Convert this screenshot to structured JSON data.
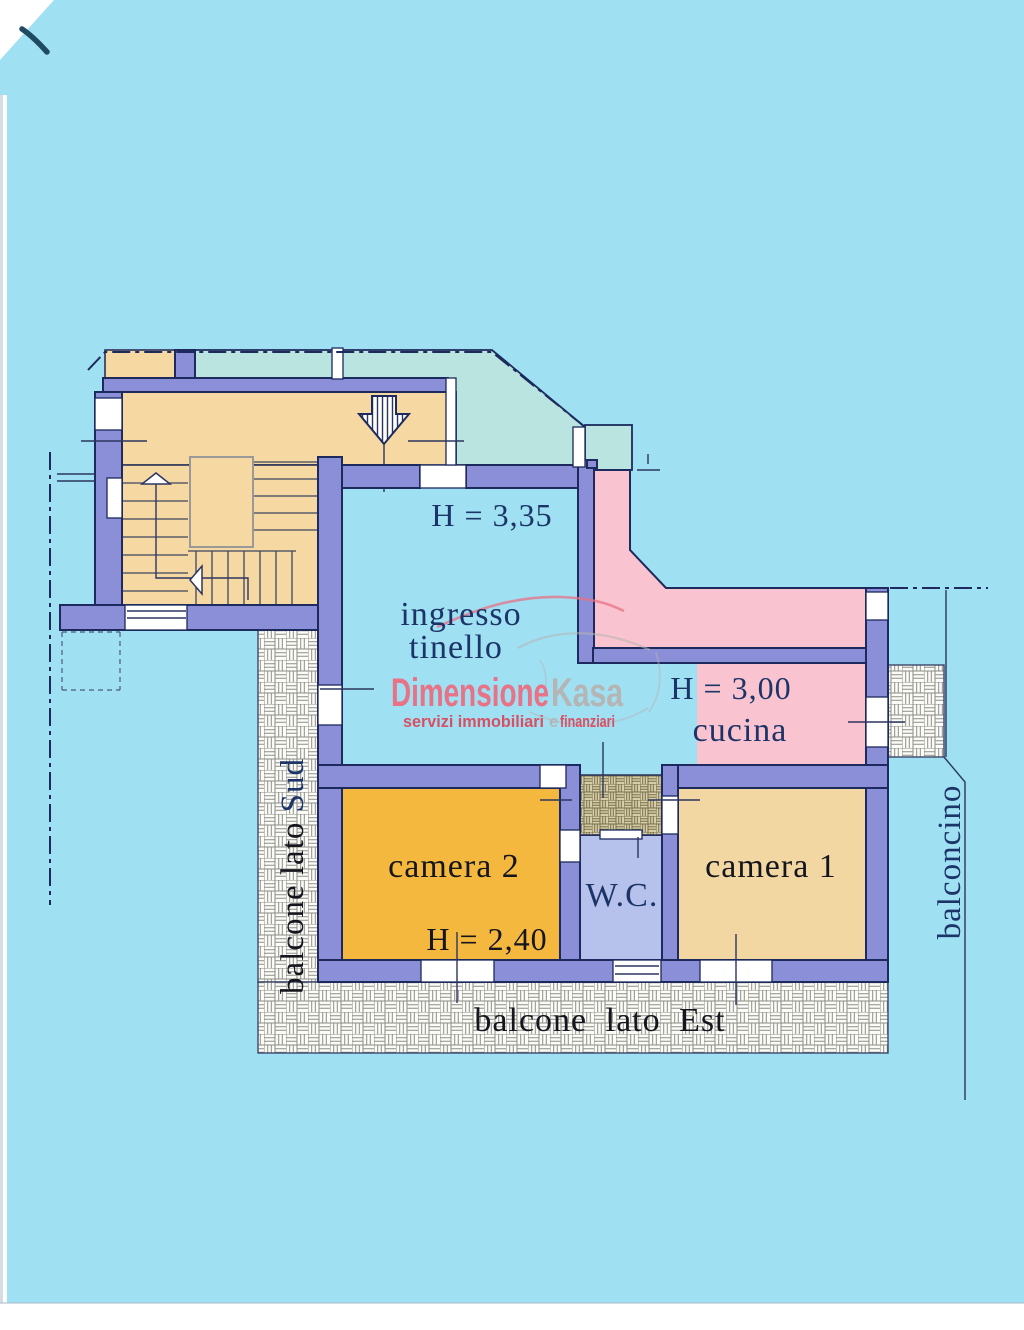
{
  "document": {
    "kind": "scanned apartment floor plan",
    "orientation_sides": [
      "Sud",
      "Est"
    ]
  },
  "labels": {
    "hall_height": "H = 3,35",
    "hall_name_line1": "ingresso",
    "hall_name_line2": "tinello",
    "kitchen_height": "H = 3,00",
    "kitchen_name": "cucina",
    "bedroom2_name": "camera 2",
    "bedroom2_height": "H = 2,40",
    "wc_name": "W.C.",
    "bedroom1_name": "camera 1",
    "balcony_south_prefix": "balcone lato ",
    "balcony_south_word": "Sud",
    "balcony_east": "balcone lato Est",
    "small_balcony": "balconcino"
  },
  "logo": {
    "brand_part1": "Dimensione",
    "brand_part2": "Kasa",
    "tagline_part1": "servizi immobiliari",
    "tagline_conj": "e",
    "tagline_part2": "finanziari"
  },
  "colors": {
    "background": "#9fe0f2",
    "wall_fill": "#8b8fd8",
    "wall_outline": "#1c2a5e",
    "neighbor_area": "#b9e4df",
    "stair_floor": "#f5d8a2",
    "camera1_floor": "#f2d7a2",
    "camera2_floor": "#f5b83e",
    "kitchen_floor": "#f9c3cf",
    "wc_floor": "#b7c2ec",
    "tile_hatch": "#d8cda4",
    "tile_hatch_line": "#75704f",
    "balcony_hatch_line": "#8e8e86",
    "label_navy": "#1c3468",
    "label_black": "#14151d",
    "logo_pink": "#e87286",
    "logo_gray": "#b5b5b5",
    "tagline_red": "#d94f63",
    "pen_mark": "#1f4a63"
  }
}
